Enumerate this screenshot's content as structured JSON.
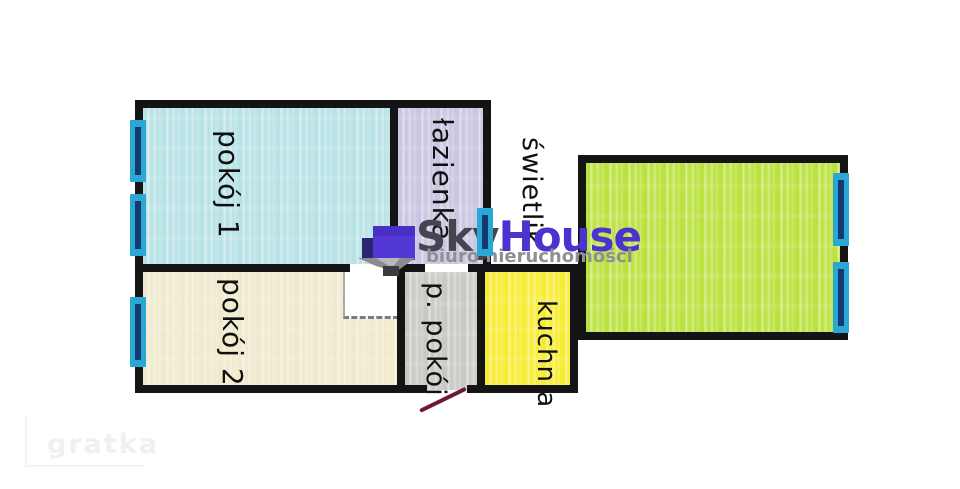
{
  "plan": {
    "rooms": [
      {
        "id": "pokoj1",
        "label": "pokój 1",
        "color": "#b7e2e6"
      },
      {
        "id": "pokoj2",
        "label": "pokój 2",
        "color": "#f0e9cd"
      },
      {
        "id": "pokoj3",
        "label": "pokój 3",
        "color": "#bbe23f"
      },
      {
        "id": "lazienka",
        "label": "łazienka",
        "color": "#c9c5e2"
      },
      {
        "id": "swietlik",
        "label": "świetlik",
        "color": "#ffffff"
      },
      {
        "id": "ppokoj",
        "label": "p. pokój",
        "color": "#c9c8c4"
      },
      {
        "id": "kuchnia",
        "label": "kuchnia",
        "color": "#f7ec33"
      }
    ],
    "wall_color": "#141414",
    "window_color": "#2ba7d6",
    "window_frame_color": "#133a6e",
    "door_line_color": "#6e1638"
  },
  "watermarks": {
    "skyhouse": {
      "part1": "Sky",
      "part2": "House",
      "subtitle": "biuro nieruchomości",
      "part1_color": "#45454f",
      "part2_color": "#4c33cf",
      "subtitle_color": "#8f9094",
      "icon_body_color": "#5438d6",
      "icon_roof_color": "#8a8a8f"
    },
    "gratka": {
      "label": "gratka",
      "color": "#eff0f1"
    }
  }
}
